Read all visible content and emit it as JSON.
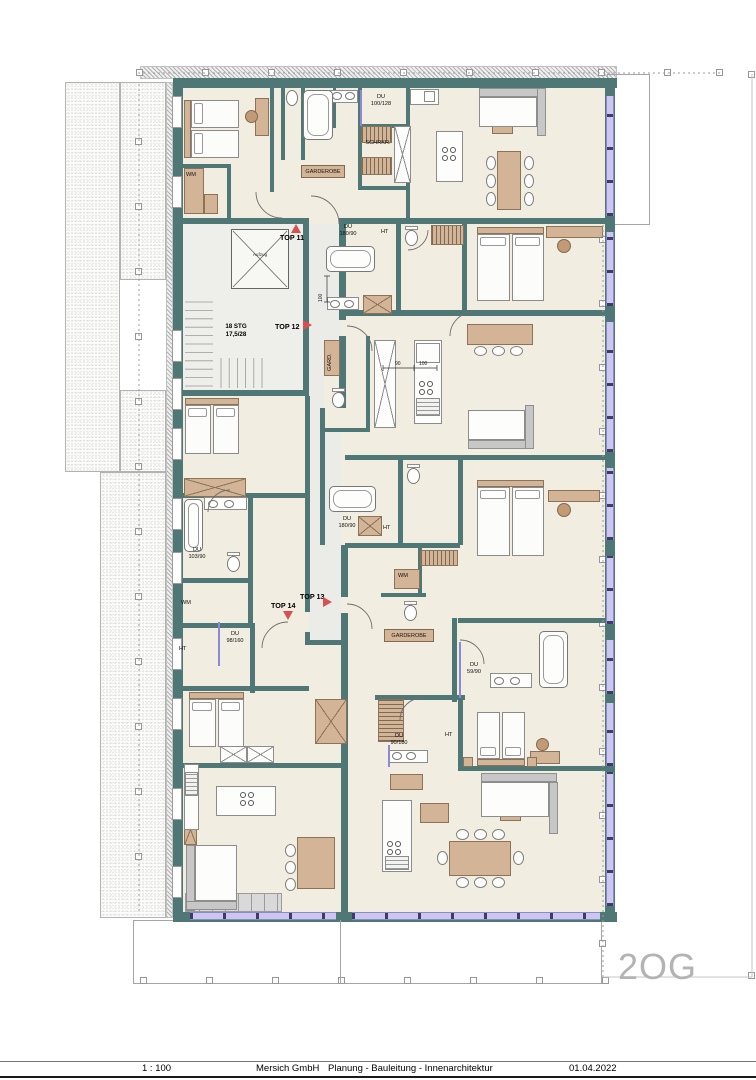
{
  "floor_label": "2OG",
  "title_block": {
    "scale": "1 : 100",
    "company": "Mersich GmbH",
    "services": "Planung - Bauleitung - Innenarchitektur",
    "date": "01.04.2022"
  },
  "stairwell": {
    "stairs": "18 STG\n17,5/28",
    "elevator": "Aufzug"
  },
  "unit_markers": {
    "top11": {
      "label": "TOP 11",
      "direction": "up"
    },
    "top12": {
      "label": "TOP 12",
      "direction": "right"
    },
    "top13": {
      "label": "TOP 13",
      "direction": "right"
    },
    "top14": {
      "label": "TOP 14",
      "direction": "down"
    }
  },
  "labels": {
    "wm1": "WM",
    "du100128": "DU\n100/128",
    "schrkr": "SCHRKR.",
    "garderobe1": "GARDEROBE",
    "du18090a": "DU\n180/90",
    "ht1": "HT",
    "dim100v": "100",
    "gard": "GARD.",
    "dim90": "90",
    "dim100": "100",
    "du10390": "DU\n103/90",
    "du18090b": "DU\n180/90",
    "ht2": "HT",
    "wm2": "WM",
    "du98160": "DU\n98/160",
    "ht3": "HT",
    "wm3": "WM",
    "garderobe2": "GARDEROBE",
    "du5990": "DU\n59/90",
    "du90180": "DU\n90/180",
    "ht4": "HT"
  },
  "colors": {
    "wall": "#4f7775",
    "floor": "#f2ede1",
    "furniture": "#d3b496",
    "marker": "#d85050",
    "glazing": "#cbc7ee"
  }
}
